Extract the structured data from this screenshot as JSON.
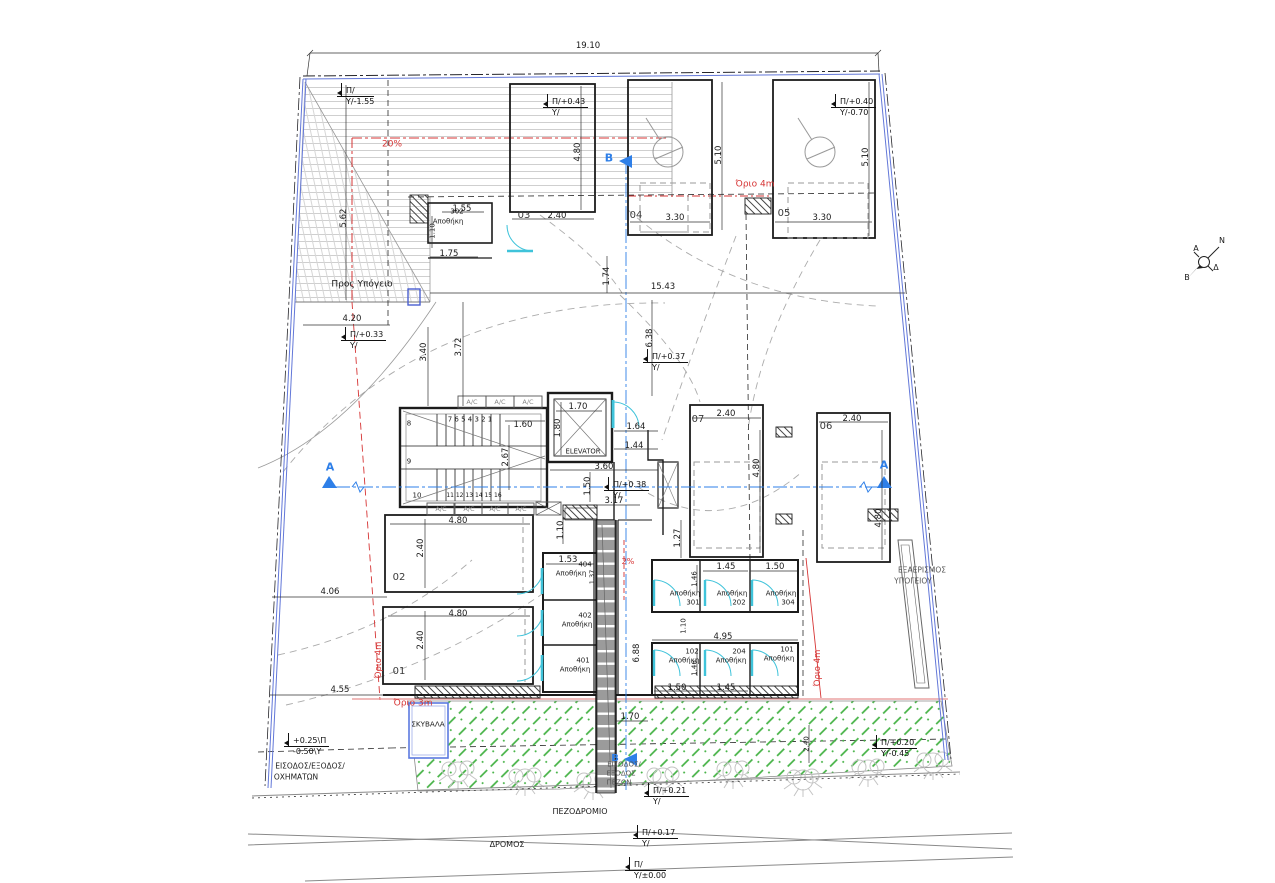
{
  "drawing": {
    "type": "architectural-site-plan",
    "language": "Greek",
    "colors": {
      "walls": "#1c1c1c",
      "boundary_blue": "#6277d8",
      "section_blue": "#2e7fe8",
      "limit_red": "#d63434",
      "door_cyan": "#3fc3da",
      "garden_green": "#43b143",
      "ramp_gray": "#9b9b9b",
      "guide_gray": "#aaaaaa"
    }
  },
  "annotations": [
    {
      "n": "dim-site-width",
      "t": "19.10",
      "x": 588,
      "y": 46
    },
    {
      "n": "dim-ramp-length",
      "t": "5.62",
      "x": 344,
      "y": 218,
      "r": 1
    },
    {
      "n": "ramp-slope",
      "t": "20%",
      "x": 392,
      "y": 145,
      "c": "red",
      "s": 9
    },
    {
      "n": "label-to-basement",
      "t": "Προς Υπόγειο",
      "x": 362,
      "y": 285,
      "s": 9
    },
    {
      "n": "dim",
      "t": "1.55",
      "x": 462,
      "y": 209
    },
    {
      "n": "storage-302-number",
      "t": "302",
      "x": 457,
      "y": 212,
      "s": 7
    },
    {
      "n": "storage-302-label",
      "t": "Αποθήκη",
      "x": 448,
      "y": 222,
      "s": 7
    },
    {
      "n": "dim",
      "t": "1.75",
      "x": 449,
      "y": 254
    },
    {
      "n": "dim",
      "t": "1.10",
      "x": 433,
      "y": 231,
      "r": 1,
      "s": 7
    },
    {
      "n": "parking-spot-03",
      "t": "03",
      "x": 524,
      "y": 216,
      "s": 10,
      "c": "dark"
    },
    {
      "n": "dim",
      "t": "2.40",
      "x": 557,
      "y": 216
    },
    {
      "n": "dim",
      "t": "4.80",
      "x": 578,
      "y": 152,
      "r": 1
    },
    {
      "n": "section-b-top",
      "t": "B",
      "x": 609,
      "y": 158,
      "c": "blue",
      "s": 11
    },
    {
      "n": "parking-spot-04",
      "t": "04",
      "x": 636,
      "y": 216,
      "s": 10,
      "c": "dark"
    },
    {
      "n": "dim",
      "t": "3.30",
      "x": 675,
      "y": 218
    },
    {
      "n": "dim",
      "t": "5.10",
      "x": 719,
      "y": 155,
      "r": 1
    },
    {
      "n": "limit-4m-top",
      "t": "Όριο 4m",
      "x": 755,
      "y": 185,
      "c": "red",
      "s": 9
    },
    {
      "n": "parking-spot-05",
      "t": "05",
      "x": 784,
      "y": 214,
      "s": 10,
      "c": "dark"
    },
    {
      "n": "dim",
      "t": "3.30",
      "x": 822,
      "y": 218
    },
    {
      "n": "dim",
      "t": "5.10",
      "x": 866,
      "y": 157,
      "r": 1
    },
    {
      "n": "dim",
      "t": "15.43",
      "x": 663,
      "y": 287
    },
    {
      "n": "dim",
      "t": "1.74",
      "x": 607,
      "y": 276,
      "r": 1
    },
    {
      "n": "dim",
      "t": "4.20",
      "x": 352,
      "y": 319
    },
    {
      "n": "dim",
      "t": "3.40",
      "x": 424,
      "y": 352,
      "r": 1
    },
    {
      "n": "dim",
      "t": "3.72",
      "x": 459,
      "y": 347,
      "r": 1
    },
    {
      "n": "dim",
      "t": "6.38",
      "x": 650,
      "y": 338,
      "r": 1
    },
    {
      "n": "ac-unit",
      "t": "A/C",
      "x": 472,
      "y": 402,
      "s": 6.5,
      "c": "gray"
    },
    {
      "n": "ac-unit",
      "t": "A/C",
      "x": 500,
      "y": 402,
      "s": 6.5,
      "c": "gray"
    },
    {
      "n": "ac-unit",
      "t": "A/C",
      "x": 528,
      "y": 402,
      "s": 6.5,
      "c": "gray"
    },
    {
      "n": "stair-step-numbers-upper",
      "t": "7 6 5 4 3 2 1",
      "x": 470,
      "y": 420,
      "s": 7
    },
    {
      "n": "stair-step-number",
      "t": "8",
      "x": 409,
      "y": 424,
      "s": 7
    },
    {
      "n": "stair-step-number",
      "t": "9",
      "x": 409,
      "y": 462,
      "s": 7
    },
    {
      "n": "stair-step-number",
      "t": "10",
      "x": 417,
      "y": 496,
      "s": 7
    },
    {
      "n": "stair-step-numbers-lower",
      "t": "11 12 13 14 15 16",
      "x": 474,
      "y": 496,
      "s": 6
    },
    {
      "n": "dim",
      "t": "1.60",
      "x": 523,
      "y": 425
    },
    {
      "n": "dim",
      "t": "2.67",
      "x": 506,
      "y": 457,
      "r": 1
    },
    {
      "n": "dim",
      "t": "1.70",
      "x": 578,
      "y": 407
    },
    {
      "n": "dim",
      "t": "1.80",
      "x": 558,
      "y": 428,
      "r": 1
    },
    {
      "n": "elevator-label",
      "t": "ELEVATOR",
      "x": 583,
      "y": 452,
      "s": 6.8
    },
    {
      "n": "dim",
      "t": "1.64",
      "x": 636,
      "y": 427
    },
    {
      "n": "dim",
      "t": "1.44",
      "x": 634,
      "y": 446
    },
    {
      "n": "dim",
      "t": "3.60",
      "x": 604,
      "y": 467
    },
    {
      "n": "dim",
      "t": "1.50",
      "x": 588,
      "y": 486,
      "r": 1
    },
    {
      "n": "dim",
      "t": "3.17",
      "x": 614,
      "y": 501
    },
    {
      "n": "ac-unit",
      "t": "A/C",
      "x": 441,
      "y": 509,
      "s": 6.5,
      "c": "gray"
    },
    {
      "n": "ac-unit",
      "t": "A/C",
      "x": 469,
      "y": 509,
      "s": 6.5,
      "c": "gray"
    },
    {
      "n": "ac-unit",
      "t": "A/C",
      "x": 495,
      "y": 509,
      "s": 6.5,
      "c": "gray"
    },
    {
      "n": "ac-unit",
      "t": "A/C",
      "x": 521,
      "y": 509,
      "s": 6.5,
      "c": "gray"
    },
    {
      "n": "parking-spot-07",
      "t": "07",
      "x": 698,
      "y": 420,
      "s": 10,
      "c": "dark"
    },
    {
      "n": "dim",
      "t": "2.40",
      "x": 726,
      "y": 414
    },
    {
      "n": "dim",
      "t": "4.80",
      "x": 757,
      "y": 468,
      "r": 1
    },
    {
      "n": "parking-spot-06",
      "t": "06",
      "x": 826,
      "y": 427,
      "s": 10,
      "c": "dark"
    },
    {
      "n": "dim",
      "t": "2.40",
      "x": 852,
      "y": 419
    },
    {
      "n": "dim",
      "t": "4.80",
      "x": 879,
      "y": 518,
      "r": 1
    },
    {
      "n": "section-a-right",
      "t": "A",
      "x": 884,
      "y": 465,
      "c": "blue",
      "s": 11
    },
    {
      "n": "section-a-left",
      "t": "A",
      "x": 330,
      "y": 467,
      "c": "blue",
      "s": 11
    },
    {
      "n": "vent-label-line1",
      "t": "ΕΞΑΕΡΙΣΜΟΣ",
      "x": 922,
      "y": 570,
      "s": 7.5,
      "c": "gray2"
    },
    {
      "n": "vent-label-line2",
      "t": "ΥΠΟΓΕΙΟΥ",
      "x": 913,
      "y": 581,
      "s": 7.5,
      "c": "gray2"
    },
    {
      "n": "dim",
      "t": "4.80",
      "x": 458,
      "y": 521
    },
    {
      "n": "dim",
      "t": "2.40",
      "x": 421,
      "y": 548,
      "r": 1
    },
    {
      "n": "parking-spot-02",
      "t": "02",
      "x": 399,
      "y": 578,
      "s": 10,
      "c": "dark"
    },
    {
      "n": "dim",
      "t": "4.06",
      "x": 330,
      "y": 592
    },
    {
      "n": "dim",
      "t": "4.80",
      "x": 458,
      "y": 614
    },
    {
      "n": "dim",
      "t": "2.40",
      "x": 421,
      "y": 640,
      "r": 1
    },
    {
      "n": "parking-spot-01",
      "t": "01",
      "x": 399,
      "y": 672,
      "s": 10,
      "c": "dark"
    },
    {
      "n": "dim",
      "t": "4.55",
      "x": 340,
      "y": 690
    },
    {
      "n": "dim",
      "t": "1.10",
      "x": 561,
      "y": 530,
      "r": 1
    },
    {
      "n": "dim",
      "t": "1.53",
      "x": 568,
      "y": 560
    },
    {
      "n": "storage-404-number",
      "t": "404",
      "x": 585,
      "y": 565,
      "s": 7
    },
    {
      "n": "storage-404-label",
      "t": "Αποθήκη",
      "x": 571,
      "y": 574,
      "s": 7
    },
    {
      "n": "dim",
      "t": "1.37",
      "x": 592,
      "y": 577,
      "r": 1,
      "s": 6.5
    },
    {
      "n": "storage-402-number",
      "t": "402",
      "x": 585,
      "y": 616,
      "s": 7
    },
    {
      "n": "storage-402-label",
      "t": "Αποθήκη",
      "x": 577,
      "y": 625,
      "s": 7
    },
    {
      "n": "storage-401-number",
      "t": "401",
      "x": 583,
      "y": 661,
      "s": 7
    },
    {
      "n": "storage-401-label",
      "t": "Αποθήκη",
      "x": 575,
      "y": 670,
      "s": 7
    },
    {
      "n": "walk-slope",
      "t": "2%",
      "x": 628,
      "y": 562,
      "c": "red",
      "s": 8
    },
    {
      "n": "dim",
      "t": "6.88",
      "x": 637,
      "y": 653,
      "r": 1
    },
    {
      "n": "dim",
      "t": "1.70",
      "x": 630,
      "y": 717
    },
    {
      "n": "dim",
      "t": "1.27",
      "x": 678,
      "y": 538,
      "r": 1
    },
    {
      "n": "dim",
      "t": "1.45",
      "x": 726,
      "y": 567
    },
    {
      "n": "dim",
      "t": "1.50",
      "x": 775,
      "y": 567
    },
    {
      "n": "dim",
      "t": "1.46",
      "x": 695,
      "y": 579,
      "r": 1,
      "s": 7
    },
    {
      "n": "storage-301-label",
      "t": "Αποθήκη",
      "x": 685,
      "y": 594,
      "s": 7
    },
    {
      "n": "storage-301-number",
      "t": "301",
      "x": 693,
      "y": 603,
      "s": 7
    },
    {
      "n": "storage-202-label",
      "t": "Αποθήκη",
      "x": 732,
      "y": 594,
      "s": 7
    },
    {
      "n": "storage-202-number",
      "t": "202",
      "x": 739,
      "y": 603,
      "s": 7
    },
    {
      "n": "storage-304-label",
      "t": "Αποθήκη",
      "x": 781,
      "y": 594,
      "s": 7
    },
    {
      "n": "storage-304-number",
      "t": "304",
      "x": 788,
      "y": 603,
      "s": 7
    },
    {
      "n": "dim",
      "t": "1.10",
      "x": 684,
      "y": 626,
      "r": 1,
      "s": 7
    },
    {
      "n": "dim",
      "t": "4.95",
      "x": 723,
      "y": 637
    },
    {
      "n": "storage-102-number",
      "t": "102",
      "x": 692,
      "y": 652,
      "s": 7
    },
    {
      "n": "storage-102-label",
      "t": "Αποθήκη",
      "x": 684,
      "y": 661,
      "s": 7
    },
    {
      "n": "storage-204-number",
      "t": "204",
      "x": 739,
      "y": 652,
      "s": 7
    },
    {
      "n": "storage-204-label",
      "t": "Αποθήκη",
      "x": 731,
      "y": 661,
      "s": 7
    },
    {
      "n": "storage-101-number",
      "t": "101",
      "x": 787,
      "y": 650,
      "s": 7
    },
    {
      "n": "storage-101-label",
      "t": "Αποθήκη",
      "x": 779,
      "y": 659,
      "s": 7
    },
    {
      "n": "dim",
      "t": "1.46",
      "x": 695,
      "y": 668,
      "r": 1,
      "s": 7
    },
    {
      "n": "dim",
      "t": "1.50",
      "x": 677,
      "y": 688
    },
    {
      "n": "dim",
      "t": "1.45",
      "x": 726,
      "y": 688
    },
    {
      "n": "limit-4m-left",
      "t": "Όριο 4m",
      "x": 379,
      "y": 660,
      "r": 1,
      "c": "red",
      "s": 8.5
    },
    {
      "n": "limit-3m",
      "t": "Όριο 3m",
      "x": 413,
      "y": 704,
      "c": "red",
      "s": 9
    },
    {
      "n": "limit-4m-right",
      "t": "Όριο 4m",
      "x": 818,
      "y": 668,
      "r": 1,
      "c": "red",
      "s": 8.5
    },
    {
      "n": "garbage-label",
      "t": "ΣΚΥΒΑΛΑ",
      "x": 428,
      "y": 724,
      "s": 7.2
    },
    {
      "n": "vehicle-entry-label-line1",
      "t": "ΕΙΣΟΔΟΣ/ΕΞΟΔΟΣ/",
      "x": 310,
      "y": 766,
      "s": 7.5
    },
    {
      "n": "vehicle-entry-label-line2",
      "t": "ΟΧΗΜΑΤΩΝ",
      "x": 296,
      "y": 777,
      "s": 7.5
    },
    {
      "n": "section-b-bottom",
      "t": "B",
      "x": 615,
      "y": 759,
      "c": "blue",
      "s": 10
    },
    {
      "n": "ped-entry-label-line1",
      "t": "ΕΙΣΟΔΟΣ/",
      "x": 624,
      "y": 765,
      "s": 7,
      "c": "gray2"
    },
    {
      "n": "ped-entry-label-line2",
      "t": "ΕΞΟΔΟΣ",
      "x": 621,
      "y": 774,
      "s": 7,
      "c": "gray2"
    },
    {
      "n": "ped-entry-label-line3",
      "t": "ΠΕΖΩΝ",
      "x": 619,
      "y": 783,
      "s": 7,
      "c": "gray2"
    },
    {
      "n": "sidewalk-label",
      "t": "ΠΕΖΟΔΡΟΜΙΟ",
      "x": 580,
      "y": 812,
      "s": 8
    },
    {
      "n": "road-label",
      "t": "ΔΡΟΜΟΣ",
      "x": 507,
      "y": 845,
      "s": 8
    },
    {
      "n": "dim",
      "t": "2.40",
      "x": 807,
      "y": 744,
      "r": 1,
      "s": 7
    },
    {
      "n": "compass-label-n",
      "t": "Ν",
      "x": 1222,
      "y": 241,
      "s": 8
    },
    {
      "n": "compass-label-a",
      "t": "Α",
      "x": 1196,
      "y": 249,
      "s": 8
    },
    {
      "n": "compass-label-d",
      "t": "Δ",
      "x": 1216,
      "y": 268,
      "s": 8
    },
    {
      "n": "compass-label-b",
      "t": "Β",
      "x": 1187,
      "y": 278,
      "s": 8
    }
  ],
  "levels": [
    {
      "n": "level-ramp-top",
      "top": "Π/",
      "bot": "Υ/-1.55",
      "x": 337,
      "y": 86
    },
    {
      "n": "level-spot-03",
      "top": "Π/+0.43",
      "bot": "Υ/",
      "x": 543,
      "y": 97
    },
    {
      "n": "level-spot-05",
      "top": "Π/+0.40",
      "bot": "Υ/-0.70",
      "x": 831,
      "y": 97
    },
    {
      "n": "level-west",
      "top": "Π/+0.33",
      "bot": "Υ/",
      "x": 341,
      "y": 330
    },
    {
      "n": "level-mid",
      "top": "Π/+0.37",
      "bot": "Υ/",
      "x": 643,
      "y": 352
    },
    {
      "n": "level-entrance",
      "top": "Π/+0.38",
      "bot": "Υ/",
      "x": 604,
      "y": 480
    },
    {
      "n": "level-ped-entry",
      "top": "Π/+0.21",
      "bot": "Υ/",
      "x": 644,
      "y": 786
    },
    {
      "n": "level-sidewalk",
      "top": "Π/+0.17",
      "bot": "Υ/",
      "x": 633,
      "y": 828
    },
    {
      "n": "level-road",
      "top": "Π/",
      "bot": "Υ/±0.00",
      "x": 625,
      "y": 860
    },
    {
      "n": "level-garden",
      "top": "Π/+0.20",
      "bot": "Υ/-0.45",
      "x": 872,
      "y": 738
    },
    {
      "n": "level-vehicle-entry",
      "top": "+0.25\\Π",
      "bot": "-0.50\\Υ",
      "x": 284,
      "y": 736
    }
  ]
}
